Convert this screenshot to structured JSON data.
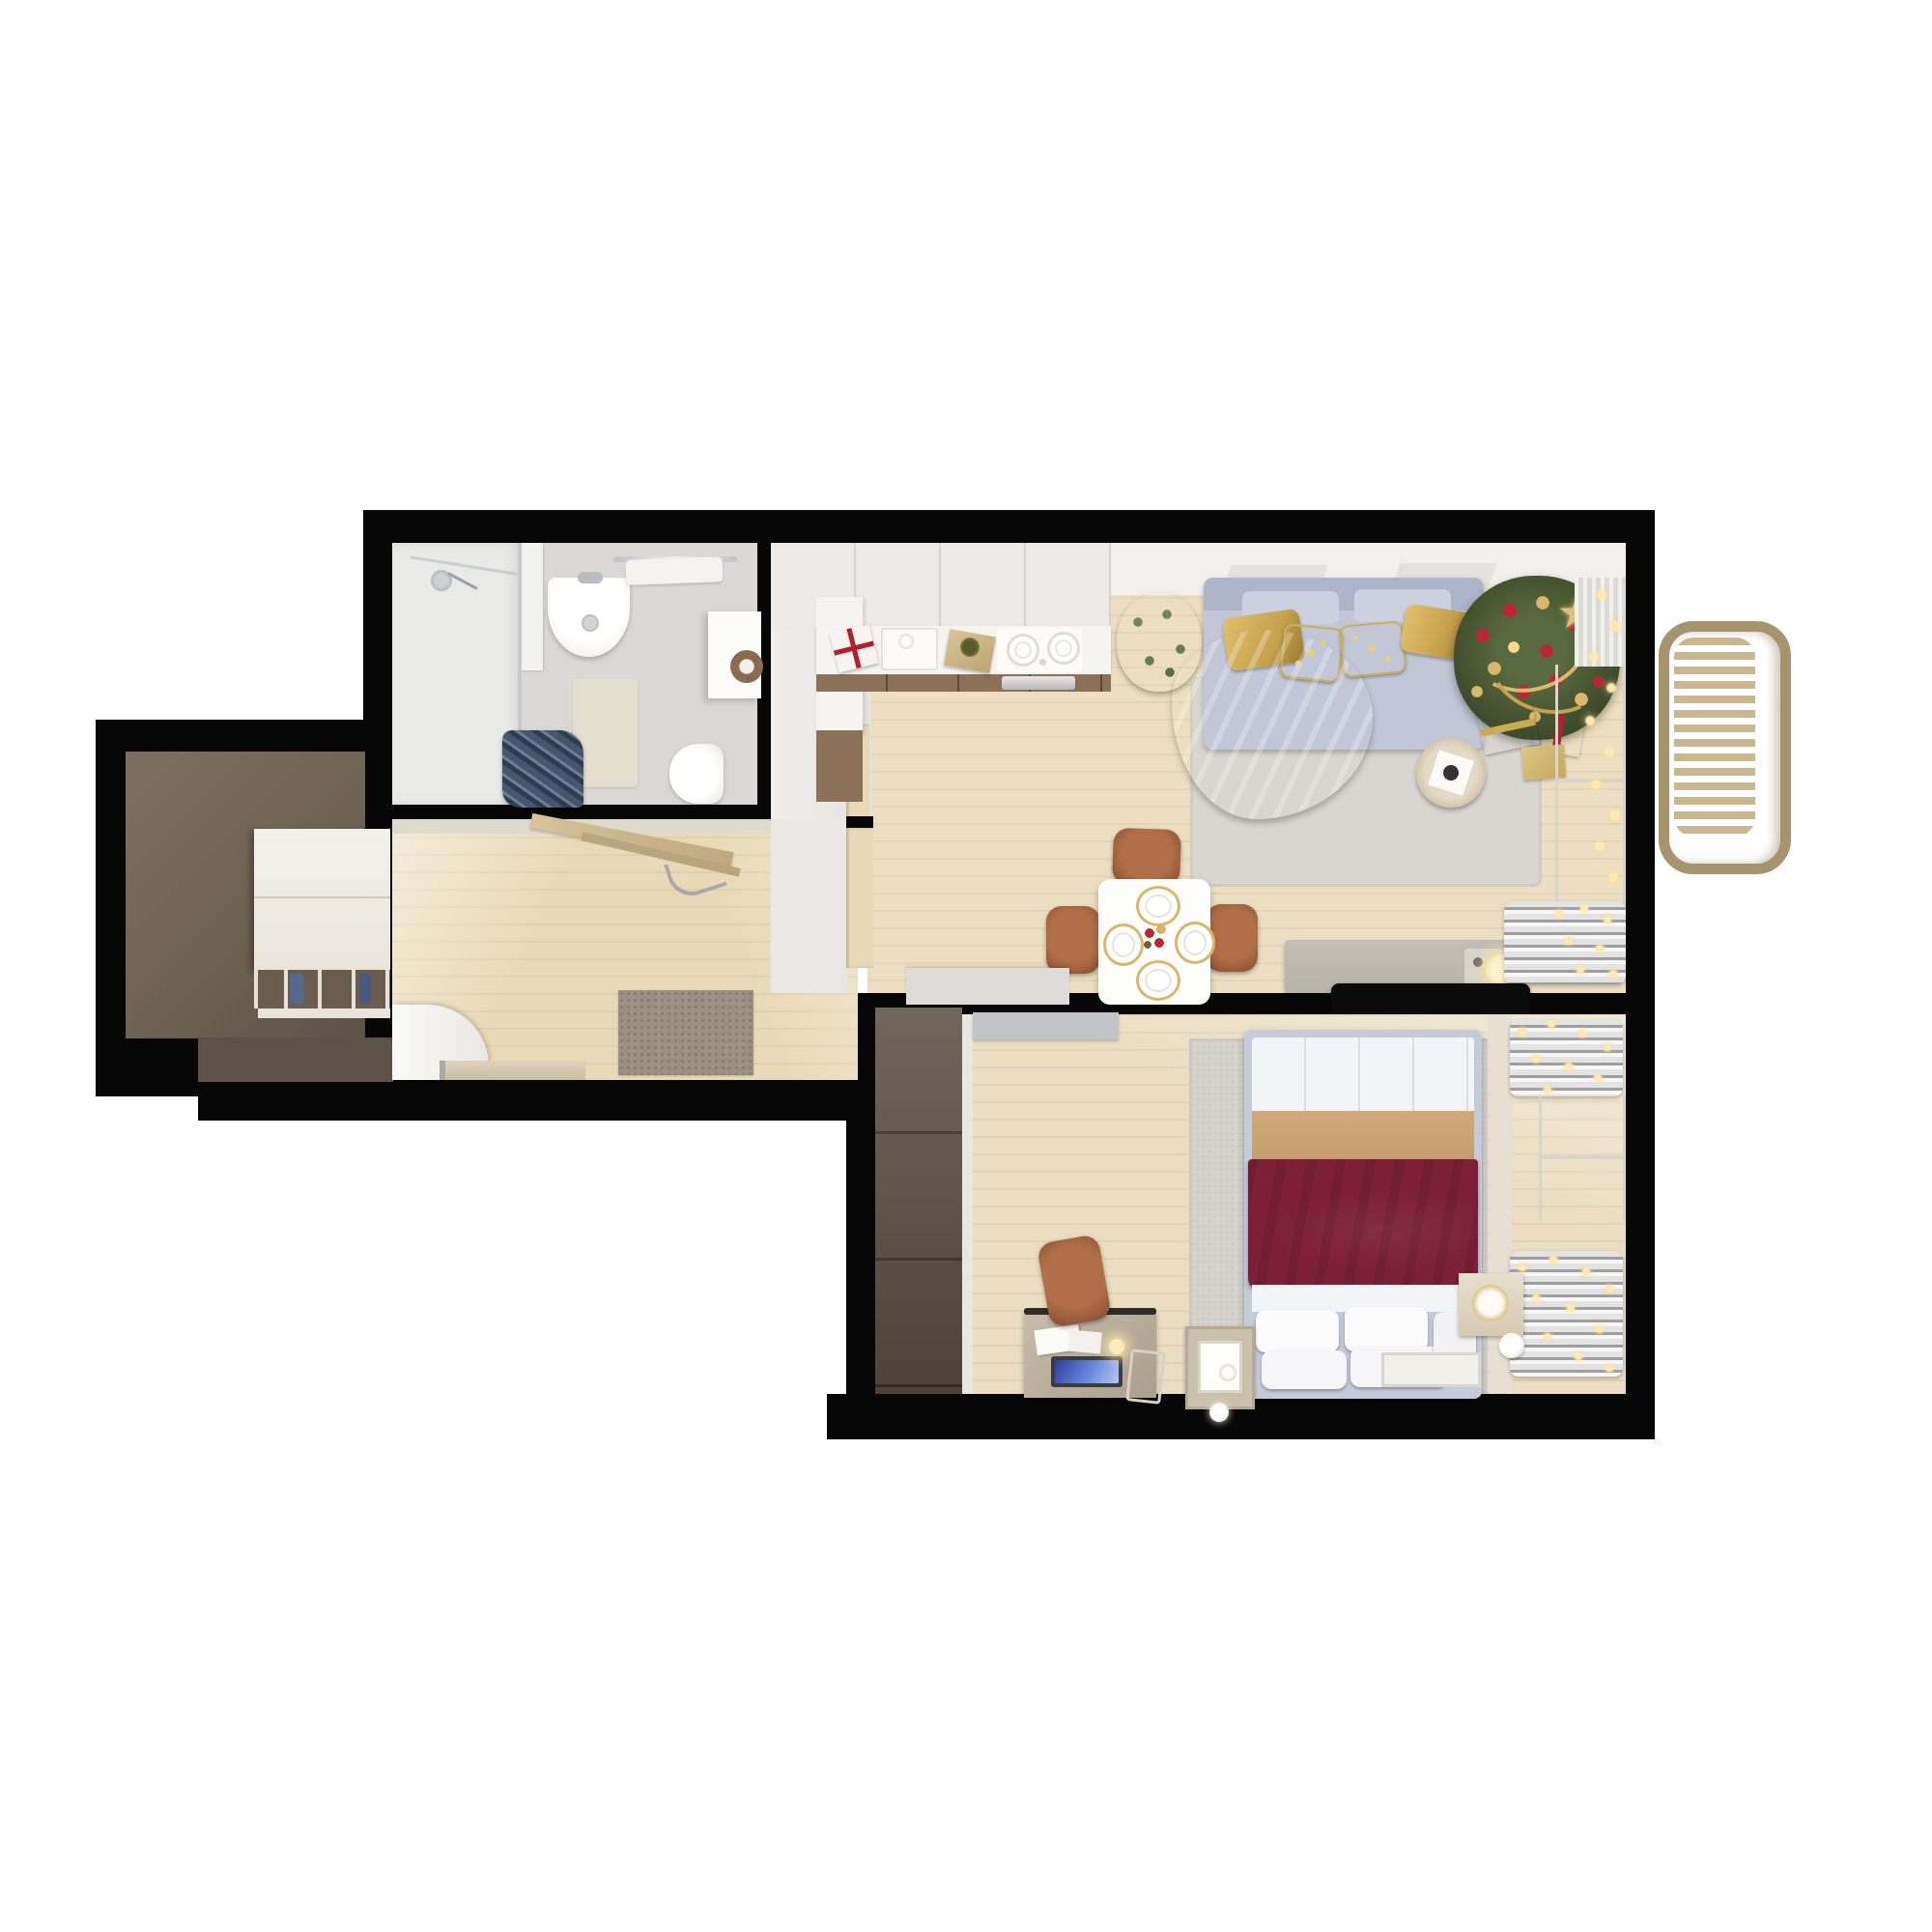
{
  "scene": {
    "type": "3d-floor-plan-top-down-render",
    "description": "Photorealistic top-down 3D render of a one-bedroom apartment decorated for Christmas, isolated on a white background with black cut walls",
    "theme": "christmas",
    "rooms": [
      {
        "name": "living-room-with-open-kitchen",
        "position": "top-right",
        "items": [
          "kitchen counter",
          "built-in sink",
          "induction cooktop",
          "oven",
          "wrapped gift with red ribbon",
          "wrapped gift with green bow",
          "green plant",
          "sofa with chaise",
          "two gold pillows",
          "two red christmas pillows",
          "light blue throw blanket",
          "area rug",
          "decorated christmas tree with star topper",
          "gold bead garland",
          "gifts under tree",
          "string fairy lights",
          "window with sheer curtain",
          "round side table",
          "tv sideboard",
          "wall-mounted tv",
          "white console",
          "square dining table with four place settings",
          "christmas centerpiece",
          "three cognac dining chairs",
          "radiator"
        ]
      },
      {
        "name": "bedroom",
        "position": "bottom-right",
        "items": [
          "double bed",
          "burgundy bedspread",
          "camel throw fold",
          "four white pillows",
          "area rug",
          "tall walnut wardrobe",
          "gray sliding door panel",
          "desk with laptop and papers",
          "desk lamp",
          "cognac desk chair",
          "nightstand with photo frame",
          "cream nightstand with gold clock",
          "floor spotlight",
          "two radiators wrapped with fairy-light garlands",
          "window",
          "small floor mat"
        ]
      },
      {
        "name": "bathroom",
        "position": "top-left",
        "items": [
          "walk-in shower with glass panel",
          "shower head",
          "wall-hung basin with faucet",
          "chrome towel rail with towels",
          "storage cabinet",
          "toilet",
          "beige bath mat",
          "towel radiator with navy towels"
        ]
      },
      {
        "name": "hallway",
        "position": "center-left",
        "items": [
          "wooden coat rack with hanger",
          "speckled doormat",
          "white open door",
          "wooden bench board"
        ]
      },
      {
        "name": "entry-nook",
        "position": "far-left",
        "items": [
          "taupe floor",
          "white built-in wardrobe",
          "shoe cubbies with blue shoes"
        ]
      },
      {
        "name": "balcony",
        "position": "right",
        "items": [
          "rounded slatted railing"
        ]
      }
    ]
  },
  "palette": {
    "bg": "#ffffff",
    "wall": "#070707",
    "woodLiving": "#ecdfc1",
    "woodBedroom": "#eaddc0",
    "woodCorridor": "#e8dab6",
    "bathFloor": "#d9d8d6",
    "showerFloor": "#e9e9e7",
    "entryFloorLight": "#7d6f60",
    "entryFloorDark": "#5d5248",
    "rugLiving": "#d9d6cf",
    "rugBedroom": "#d6d3ce",
    "sofa": "#c2c7d7",
    "sofaDark": "#aeb4c9",
    "blanketBlue": "#a9c2cd",
    "pillowGold": "#c8a24e",
    "pillowRed": "#a5121d",
    "treeGreen": "#47552f",
    "ornamentRed": "#bf2433",
    "ornamentGold": "#d9b969",
    "counterWhite": "#f5f4f0",
    "cabinetUpper": "#eceae6",
    "cabinetWood": "#8b7157",
    "chairCognac": "#9d5f3d",
    "tableWhite": "#fdfdfc",
    "sideboardGray": "#b7b3ab",
    "consoleWhite": "#dedcd8",
    "tvBlack": "#0b0b0b",
    "radiatorSilver": "#cccccc",
    "balconyFrame": "#a6946f",
    "balconySlat": "#c9b88f",
    "bedFrame": "#c6cbda",
    "bedWhite": "#f3f4f6",
    "bedTan": "#c59c6e",
    "bedBurgundy": "#7d1f37",
    "wardrobeBrown": "#5e5144",
    "doorGray": "#c3c4c8",
    "windowGlow": "#fbf7ea",
    "curtain": "#dadad6",
    "lightWarm": "#ffe9b3",
    "doormat": "#9a9182",
    "matBeige": "#e4decf",
    "towelNavy": "#46566c"
  }
}
